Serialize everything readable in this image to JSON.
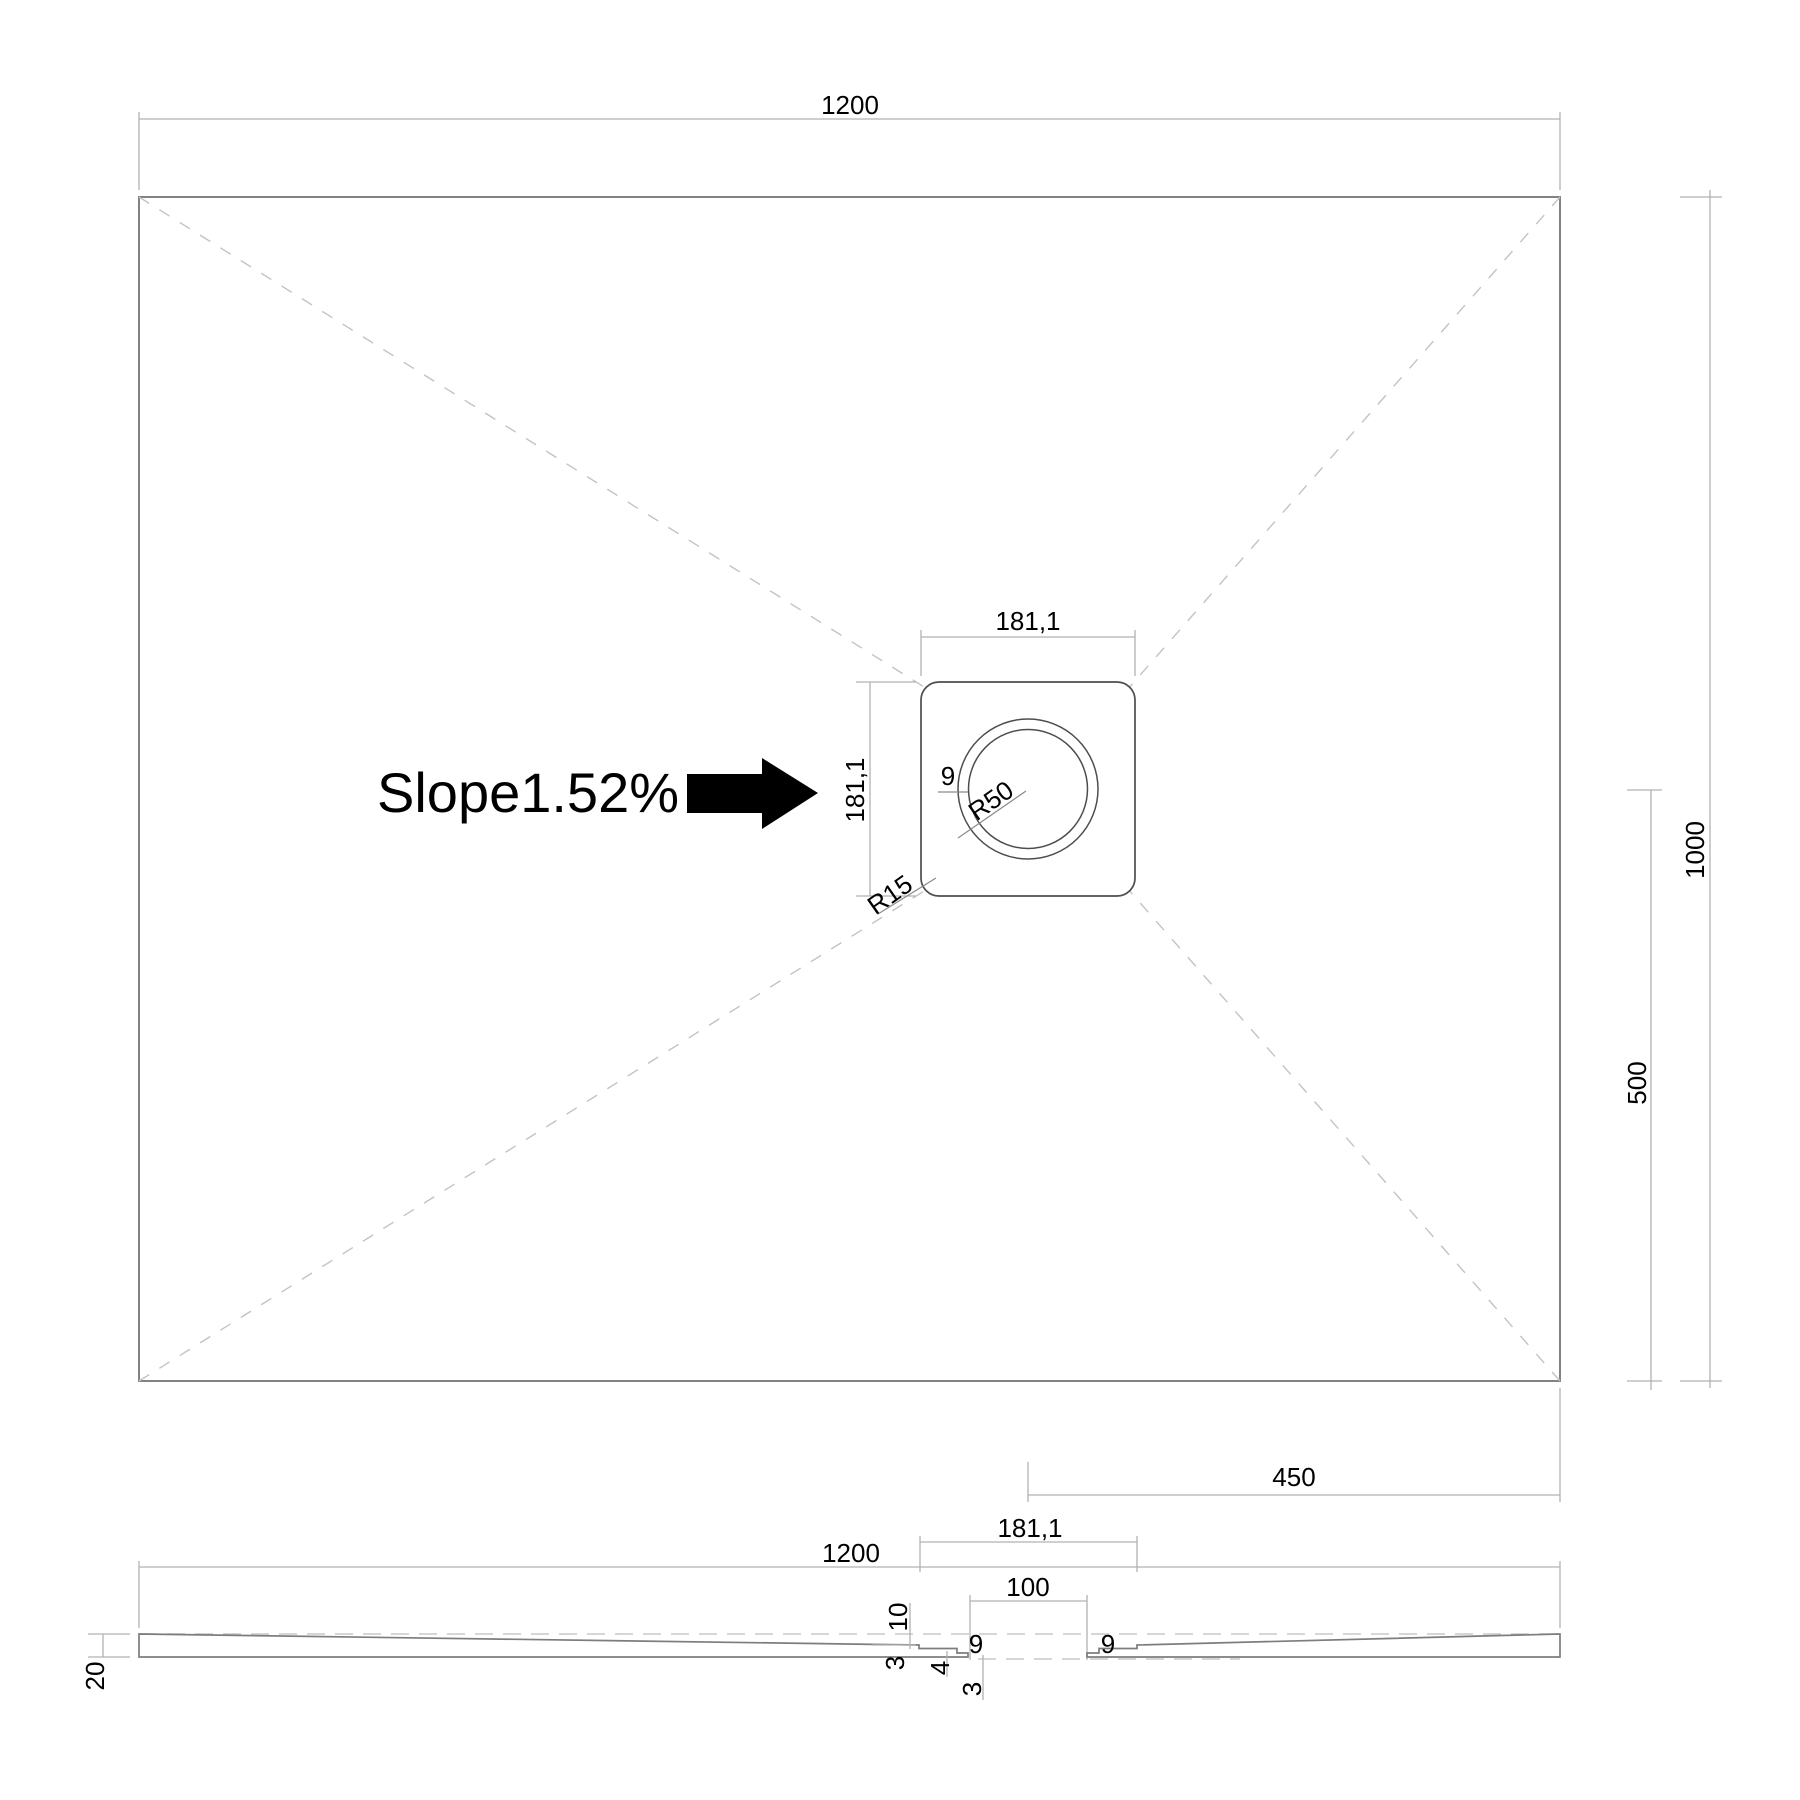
{
  "top_view": {
    "width_label": "1200",
    "height_label": "1000",
    "half_height_label": "500",
    "drain_offset_label": "450",
    "slope_label": "Slope1.52%",
    "drain": {
      "width_label": "181,1",
      "height_label": "181,1",
      "ring_width_label": "9",
      "inner_radius_label": "R50",
      "corner_radius_label": "R15"
    }
  },
  "section_view": {
    "width_label": "1200",
    "flange_width_label": "181,1",
    "hole_width_label": "100",
    "depth_label": "10",
    "edge_step_label": "3",
    "mid_step_label": "4",
    "lip_label": "3",
    "left_ring_label": "9",
    "right_ring_label": "9",
    "thickness_label": "20"
  }
}
